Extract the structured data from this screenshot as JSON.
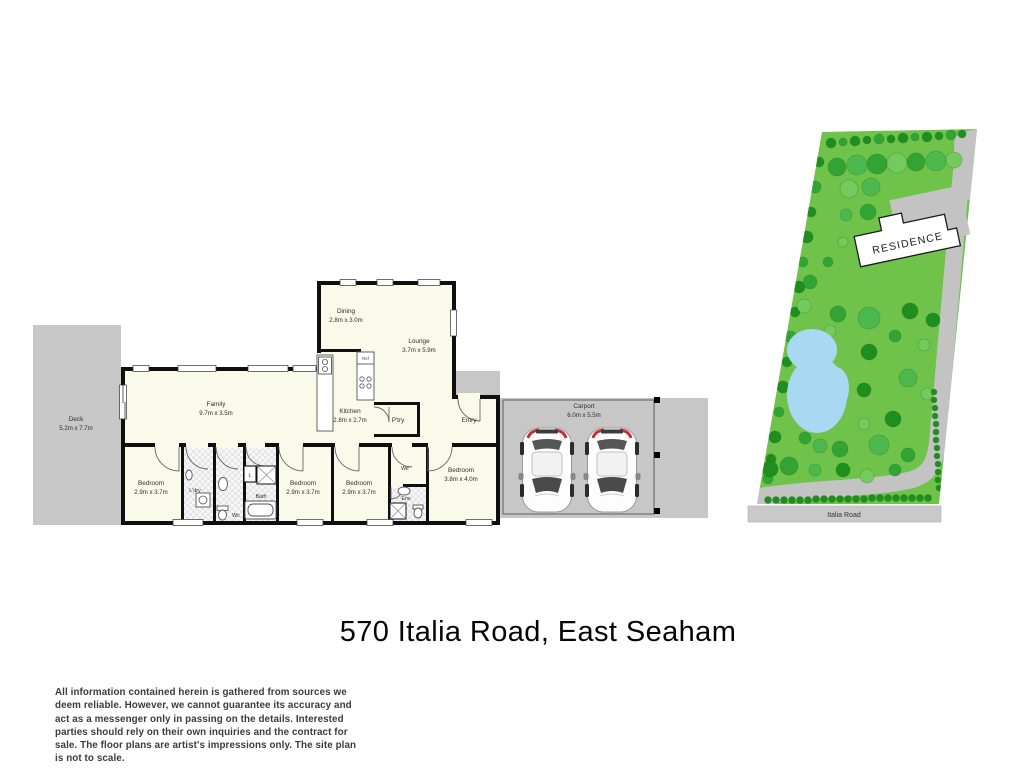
{
  "title": "570 Italia Road, East Seaham",
  "disclaimer": "All information contained herein is gathered from sources we deem reliable. However, we cannot guarantee its accuracy and act as a messenger only in passing on the details. Interested parties should rely on their own inquiries and the contract for sale. The floor plans are artist's impressions only. The site plan is not to scale.",
  "floorplan": {
    "rooms": {
      "deck": {
        "name": "Deck",
        "dims": "5.2m x 7.7m"
      },
      "dining": {
        "name": "Dining",
        "dims": "2.8m x 3.0m"
      },
      "lounge": {
        "name": "Lounge",
        "dims": "3.7m x 5.9m"
      },
      "family": {
        "name": "Family",
        "dims": "9.7m x 3.5m"
      },
      "kitchen": {
        "name": "Kitchen",
        "dims": "2.8m x 2.7m"
      },
      "pantry": {
        "name": "P'try"
      },
      "entry": {
        "name": "Entry"
      },
      "carport": {
        "name": "Carport",
        "dims": "6.0m x 5.5m"
      },
      "bedroom1": {
        "name": "Bedroom",
        "dims": "2.9m x 3.7m"
      },
      "bedroom2": {
        "name": "Bedroom",
        "dims": "2.9m x 3.7m"
      },
      "bedroom3": {
        "name": "Bedroom",
        "dims": "2.9m x 3.7m"
      },
      "bedroom4": {
        "name": "Bedroom",
        "dims": "3.8m x 4.0m"
      },
      "laundry": {
        "name": "L'dry"
      },
      "wc": {
        "name": "Wc"
      },
      "linen": {
        "name": "L"
      },
      "bath": {
        "name": "Bath"
      },
      "wir": {
        "name": "Wir"
      },
      "ens": {
        "name": "Ens"
      },
      "fridge": {
        "name": "Ref"
      }
    }
  },
  "siteplan": {
    "residence_label": "RESIDENCE",
    "road_label": "Italia Road",
    "colors": {
      "grass": "#6fc34b",
      "pond": "#a8d8f2",
      "paving": "#c3c3c3",
      "road": "#c9c9c9",
      "tree_shades": [
        "#1e8f1e",
        "#33a433",
        "#4db84d",
        "#74ca5c",
        "#97d884"
      ]
    },
    "trees": [
      [
        831,
        143,
        5,
        0
      ],
      [
        843,
        142,
        4,
        1
      ],
      [
        855,
        141,
        5,
        0
      ],
      [
        867,
        140,
        4,
        0
      ],
      [
        879,
        139,
        5,
        1
      ],
      [
        891,
        139,
        4,
        0
      ],
      [
        903,
        138,
        5,
        0
      ],
      [
        915,
        137,
        4,
        1
      ],
      [
        927,
        137,
        5,
        0
      ],
      [
        939,
        136,
        4,
        0
      ],
      [
        951,
        135,
        5,
        1
      ],
      [
        962,
        134,
        4,
        0
      ],
      [
        837,
        167,
        9,
        1
      ],
      [
        857,
        165,
        10,
        2
      ],
      [
        877,
        164,
        10,
        1
      ],
      [
        897,
        163,
        10,
        3
      ],
      [
        916,
        162,
        9,
        1
      ],
      [
        936,
        161,
        10,
        2
      ],
      [
        954,
        160,
        8,
        3
      ],
      [
        819,
        162,
        5,
        0
      ],
      [
        815,
        187,
        6,
        1
      ],
      [
        811,
        212,
        5,
        0
      ],
      [
        807,
        237,
        6,
        0
      ],
      [
        803,
        262,
        5,
        1
      ],
      [
        799,
        287,
        6,
        0
      ],
      [
        795,
        312,
        5,
        0
      ],
      [
        791,
        337,
        6,
        1
      ],
      [
        787,
        362,
        5,
        0
      ],
      [
        783,
        387,
        6,
        0
      ],
      [
        779,
        412,
        5,
        1
      ],
      [
        775,
        437,
        6,
        0
      ],
      [
        771,
        459,
        5,
        0
      ],
      [
        768,
        479,
        5,
        1
      ],
      [
        849,
        189,
        9,
        3
      ],
      [
        871,
        187,
        9,
        2
      ],
      [
        846,
        215,
        6,
        2
      ],
      [
        868,
        212,
        8,
        1
      ],
      [
        843,
        242,
        5,
        3
      ],
      [
        828,
        262,
        5,
        1
      ],
      [
        810,
        282,
        7,
        1
      ],
      [
        804,
        306,
        7,
        3
      ],
      [
        838,
        314,
        8,
        1
      ],
      [
        869,
        318,
        11,
        2
      ],
      [
        910,
        311,
        8,
        0
      ],
      [
        933,
        320,
        7,
        0
      ],
      [
        830,
        331,
        6,
        3
      ],
      [
        895,
        336,
        6,
        1
      ],
      [
        924,
        345,
        6,
        3
      ],
      [
        869,
        352,
        8,
        0
      ],
      [
        908,
        378,
        9,
        2
      ],
      [
        864,
        390,
        7,
        0
      ],
      [
        927,
        394,
        6,
        3
      ],
      [
        893,
        419,
        8,
        0
      ],
      [
        864,
        424,
        6,
        3
      ],
      [
        830,
        420,
        7,
        2
      ],
      [
        805,
        438,
        6,
        1
      ],
      [
        820,
        446,
        7,
        2
      ],
      [
        840,
        449,
        8,
        1
      ],
      [
        879,
        445,
        10,
        2
      ],
      [
        908,
        455,
        7,
        1
      ],
      [
        770,
        469,
        8,
        0
      ],
      [
        789,
        466,
        9,
        1
      ],
      [
        815,
        470,
        6,
        2
      ],
      [
        843,
        470,
        7,
        0
      ],
      [
        867,
        476,
        7,
        3
      ],
      [
        895,
        470,
        6,
        1
      ],
      [
        768,
        500,
        3.5,
        0
      ],
      [
        776,
        500,
        3.5,
        0
      ],
      [
        784,
        500,
        3.5,
        0
      ],
      [
        792,
        500,
        3.5,
        0
      ],
      [
        800,
        500,
        3.5,
        0
      ],
      [
        808,
        500,
        3.5,
        0
      ],
      [
        816,
        499,
        3.5,
        0
      ],
      [
        824,
        499,
        3.5,
        0
      ],
      [
        832,
        499,
        3.5,
        0
      ],
      [
        840,
        499,
        3.5,
        0
      ],
      [
        848,
        499,
        3.5,
        0
      ],
      [
        856,
        499,
        3.5,
        0
      ],
      [
        864,
        499,
        3.5,
        0
      ],
      [
        872,
        498,
        3.5,
        0
      ],
      [
        880,
        498,
        3.5,
        0
      ],
      [
        888,
        498,
        3.5,
        0
      ],
      [
        896,
        498,
        3.5,
        0
      ],
      [
        904,
        498,
        3.5,
        0
      ],
      [
        912,
        498,
        3.5,
        0
      ],
      [
        920,
        498,
        3.5,
        0
      ],
      [
        928,
        498,
        3.5,
        0
      ],
      [
        934,
        392,
        3,
        0
      ],
      [
        934,
        400,
        3,
        0
      ],
      [
        935,
        408,
        3,
        0
      ],
      [
        935,
        416,
        3,
        0
      ],
      [
        936,
        424,
        3,
        0
      ],
      [
        936,
        432,
        3,
        0
      ],
      [
        936,
        440,
        3,
        0
      ],
      [
        937,
        448,
        3,
        0
      ],
      [
        937,
        456,
        3,
        0
      ],
      [
        938,
        464,
        3,
        0
      ],
      [
        938,
        472,
        3,
        0
      ],
      [
        938,
        480,
        3,
        0
      ],
      [
        939,
        488,
        3,
        0
      ]
    ]
  }
}
